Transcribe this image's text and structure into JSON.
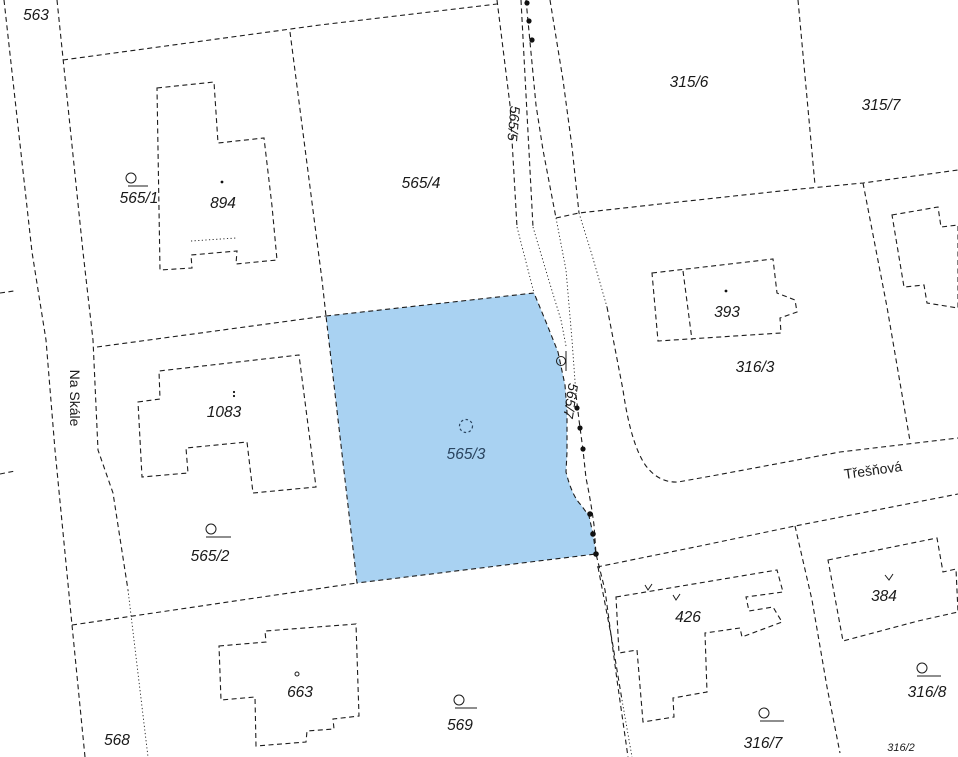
{
  "map": {
    "background_color": "#ffffff",
    "boundary_color": "#1c1c1c",
    "highlight_fill": "#a9d2f2",
    "highlight_label_color": "#2b4560",
    "streets": {
      "na_skale": "Na Skále",
      "tresnova": "Třešňová"
    },
    "parcels": {
      "p563": "563",
      "p568": "568",
      "p565_1": "565/1",
      "p565_2": "565/2",
      "p565_3": "565/3",
      "p565_4": "565/4",
      "p565_5": "565/5",
      "p565_7": "565/7",
      "p569": "569",
      "p315_6": "315/6",
      "p315_7": "315/7",
      "p316_2": "316/2",
      "p316_3": "316/3",
      "p316_7": "316/7",
      "p316_8": "316/8"
    },
    "buildings": {
      "b894": "894",
      "b1083": "1083",
      "b663": "663",
      "b426": "426",
      "b384": "384",
      "b393": "393"
    }
  }
}
